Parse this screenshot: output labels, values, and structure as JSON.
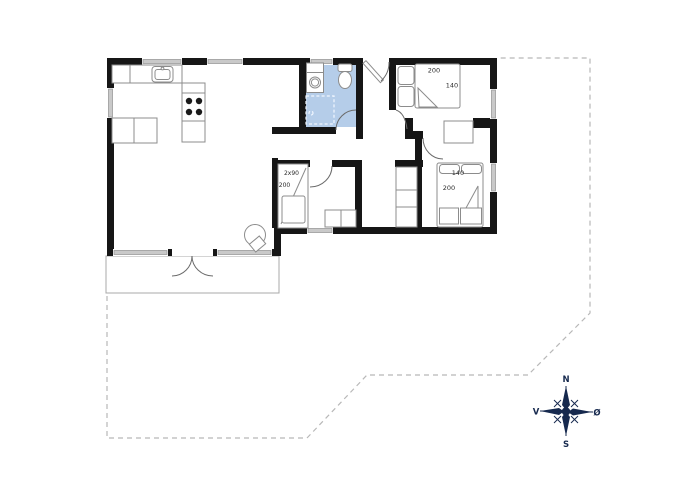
{
  "plan": {
    "colors": {
      "wall": "#161616",
      "bathroom_fill": "#b5cde9",
      "window_fill": "#c9c9c9",
      "furniture_stroke": "#8c8c8c",
      "property_boundary": "#b8b8b8",
      "compass": "#16294e"
    },
    "bedroom_main": {
      "bed_length": "200",
      "bed_width": "140"
    },
    "bedroom_second": {
      "bed_width": "140",
      "bed_length": "200"
    },
    "kids_room": {
      "bunk_label": "2x90",
      "bunk_length": "200"
    },
    "compass": {
      "north": "N",
      "east": "Ø",
      "south": "S",
      "west": "V"
    }
  }
}
